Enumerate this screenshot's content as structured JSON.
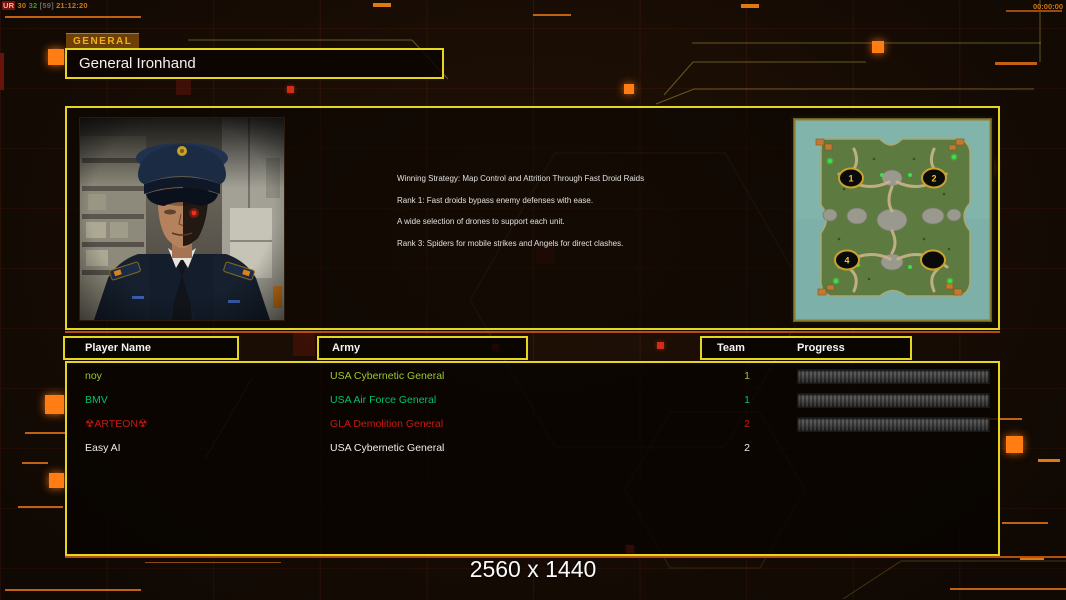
{
  "status": {
    "tag": "UR",
    "fps": "30",
    "value": "32",
    "extra": "[59]",
    "clock": "21:12:20",
    "timer": "00:00:00"
  },
  "general": {
    "tab_label": "GENERAL",
    "name": "General Ironhand",
    "strategy": [
      "Winning Strategy: Map Control and Attrition Through Fast Droid Raids",
      "Rank 1: Fast droids bypass enemy defenses with ease.",
      "A wide selection of drones to support each unit.",
      "Rank 3: Spiders for mobile strikes and Angels for direct clashes."
    ]
  },
  "minimap": {
    "markers": [
      "1",
      "2",
      "4",
      ""
    ]
  },
  "table": {
    "headers": {
      "player": "Player Name",
      "army": "Army",
      "team": "Team",
      "progress": "Progress"
    },
    "players": [
      {
        "name": "noy",
        "army": "USA Cybernetic General",
        "team": "1",
        "color": "#9cc72e",
        "has_progress": true
      },
      {
        "name": "BMV",
        "army": "USA Air Force General",
        "team": "1",
        "color": "#00c06a",
        "has_progress": true
      },
      {
        "name": "☢ARTEON☢",
        "army": "GLA Demolition General",
        "team": "2",
        "color": "#c41a10",
        "has_progress": true
      },
      {
        "name": "Easy AI",
        "army": "USA Cybernetic General",
        "team": "2",
        "color": "#ededed",
        "has_progress": false
      }
    ]
  },
  "footer": {
    "resolution": "2560 x 1440"
  },
  "colors": {
    "accent_yellow": "#e6d71e",
    "accent_orange": "#b44f10"
  }
}
